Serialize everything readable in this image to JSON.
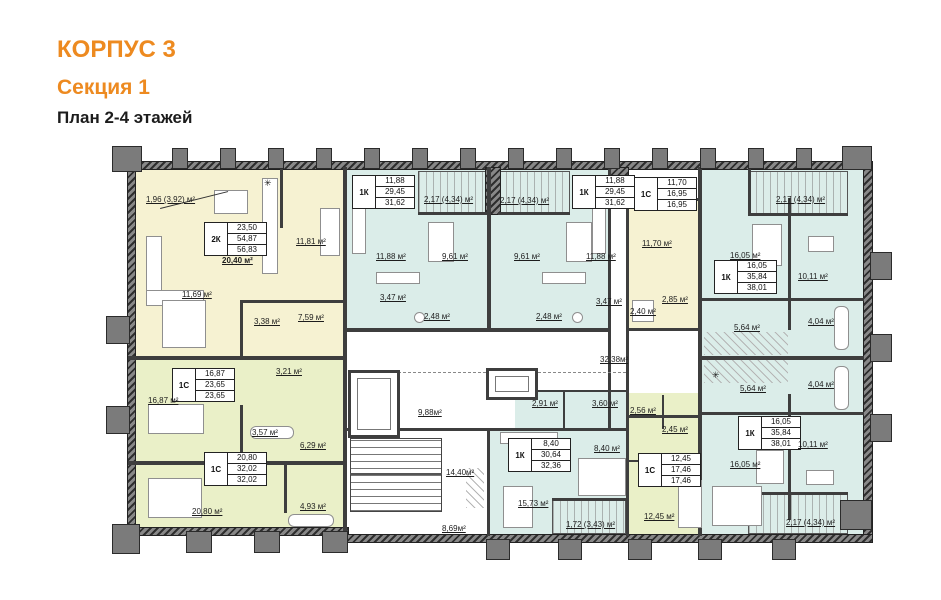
{
  "title": {
    "building": "КОРПУС 3",
    "section": "Секция 1",
    "plan": "План 2-4 этажей"
  },
  "colors": {
    "accent_orange": "#ED8A20",
    "apartment_yellow": "#F6F2D2",
    "apartment_green": "#EAF0C8",
    "apartment_blue": "#DBEDE9",
    "wall": "#3E3E3E",
    "column_gray": "#7B7B7B"
  },
  "apartments": {
    "t1": {
      "type": "2К",
      "r1": "23,50",
      "r2": "54,87",
      "r3": "56,83"
    },
    "t2": {
      "type": "1К",
      "r1": "11,88",
      "r2": "29,45",
      "r3": "31,62"
    },
    "t3": {
      "type": "1К",
      "r1": "11,88",
      "r2": "29,45",
      "r3": "31,62"
    },
    "t4": {
      "type": "1С",
      "r1": "11,70",
      "r2": "16,95",
      "r3": "16,95"
    },
    "t5": {
      "type": "1К",
      "r1": "16,05",
      "r2": "35,84",
      "r3": "38,01"
    },
    "t6": {
      "type": "1С",
      "r1": "16,87",
      "r2": "23,65",
      "r3": "23,65"
    },
    "t7": {
      "type": "1С",
      "r1": "20,80",
      "r2": "32,02",
      "r3": "32,02"
    },
    "t8": {
      "type": "1К",
      "r1": "8,40",
      "r2": "30,64",
      "r3": "32,36"
    },
    "t9": {
      "type": "1С",
      "r1": "12,45",
      "r2": "17,46",
      "r3": "17,46"
    },
    "t10": {
      "type": "1К",
      "r1": "16,05",
      "r2": "35,84",
      "r3": "38,01"
    }
  },
  "labels": {
    "bal_2k": "1,96 (3,92) м²",
    "r2k_living": "20,40 м²",
    "r2k_bed1": "11,81 м²",
    "r2k_bed2": "11,69 м²",
    "r2k_wc": "3,38 м²",
    "r2k_hall": "7,59 м²",
    "s1_living": "16,87 м²",
    "s1_hall": "3,21 м²",
    "s1_wc": "3,57 м²",
    "s2_living": "20,80 м²",
    "s2_hall": "6,29 м²",
    "s2_wc": "4,93 м²",
    "k1_room": "11,88 м²",
    "k1_kitchen": "9,61 м²",
    "k1_wc": "3,47 м²",
    "k1_hall": "2,48 м²",
    "k1_balcony": "2,17 (4,34) м²",
    "s3_living": "11,70 м²",
    "s3_wc": "2,40 м²",
    "s3_hall": "2,85 м²",
    "kr_living": "16,05 м²",
    "kr_room": "10,11 м²",
    "kr_kitchen": "5,64 м²",
    "kr_wc": "4,04 м²",
    "kr_balcony": "2,17 (4,34) м²",
    "kb_kitchen": "8,40 м²",
    "kb_living": "15,73 м²",
    "kb_balcony": "1,72 (3,43) м²",
    "kb_hall1": "2,91 м²",
    "kb_hall2": "3,60 м²",
    "s4_living": "12,45 м²",
    "s4_wc": "2,56 м²",
    "s4_hall": "2,45 м²",
    "corridor": "32,38м²",
    "lift_lobby": "9,88м²",
    "stairs": "14,40м²",
    "corridor2": "8,69м²"
  }
}
